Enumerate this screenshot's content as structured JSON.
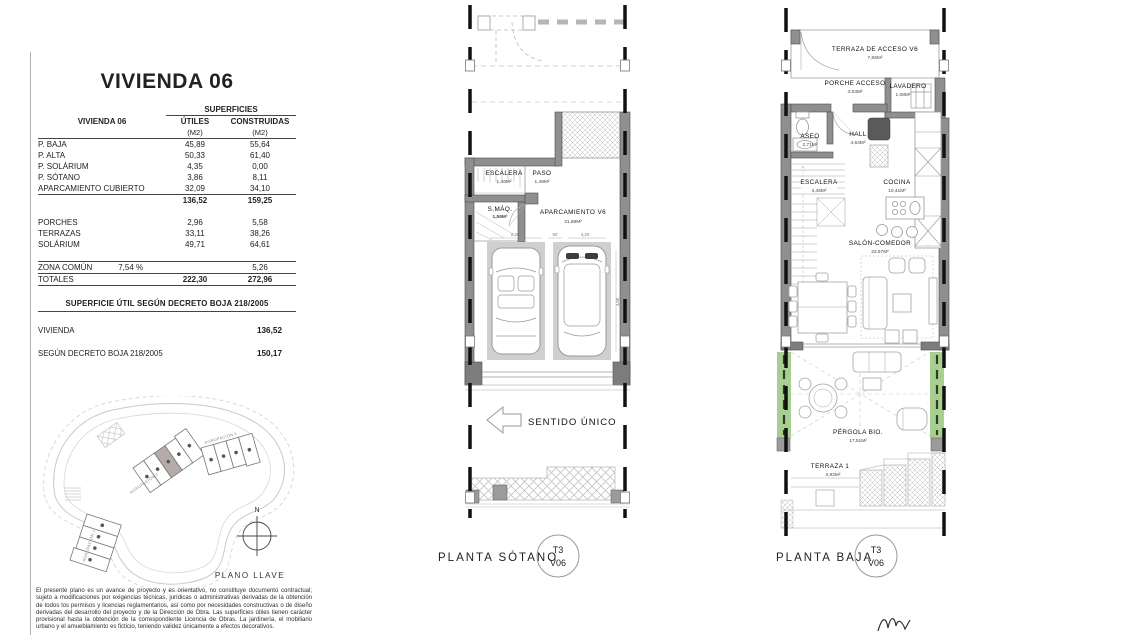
{
  "left_panel": {
    "title": "VIVIENDA 06",
    "areas_table": {
      "corner_label": "VIVIENDA 06",
      "group_header": "SUPERFICIES",
      "col_utiles": "ÚTILES",
      "col_construidas": "CONSTRUIDAS",
      "unit": "(M2)",
      "rows": [
        {
          "label": "P. BAJA",
          "utiles": "45,89",
          "construidas": "55,64"
        },
        {
          "label": "P. ALTA",
          "utiles": "50,33",
          "construidas": "61,40"
        },
        {
          "label": "P. SOLÁRIUM",
          "utiles": "4,35",
          "construidas": "0,00"
        },
        {
          "label": "P. SÓTANO",
          "utiles": "3,86",
          "construidas": "8,11"
        },
        {
          "label": "APARCAMIENTO CUBIERTO",
          "utiles": "32,09",
          "construidas": "34,10"
        }
      ],
      "subtotal": {
        "utiles": "136,52",
        "construidas": "159,25"
      },
      "extra_rows": [
        {
          "label": "PORCHES",
          "utiles": "2,96",
          "construidas": "5,58"
        },
        {
          "label": "TERRAZAS",
          "utiles": "33,11",
          "construidas": "38,26"
        },
        {
          "label": "SOLÁRIUM",
          "utiles": "49,71",
          "construidas": "64,61"
        }
      ],
      "zona_comun": {
        "label": "ZONA COMÚN",
        "pct": "7,54 %",
        "construidas": "5,26"
      },
      "totales": {
        "label": "TOTALES",
        "utiles": "222,30",
        "construidas": "272,96"
      }
    },
    "decreto_table": {
      "header": "SUPERFICIE ÚTIL SEGÚN DECRETO BOJA 218/2005",
      "rows": [
        {
          "label": "VIVIENDA",
          "value": "136,52"
        },
        {
          "label": "SEGÚN DECRETO BOJA 218/2005",
          "value": "150,17"
        }
      ]
    },
    "site_plan": {
      "north": "N",
      "caption": "PLANO LLAVE",
      "agrupacion1": "AGRUPACIÓN 1",
      "agrupacion2": "AGRUPACIÓN 2",
      "agrupacion3": "AGRUPACIÓN 3"
    },
    "disclaimer": "El presente plano es un avance de proyecto y es orientativo, no constituye documento contractual; sujeto a modificaciones por exigencias técnicas, jurídicas o administrativas derivadas de la obtención de todos los permisos y licencias reglamentarios, así como por necesidades constructivas o de diseño derivadas del desarrollo del proyecto y de la Dirección de Obra. Las superficies útiles tienen carácter provisional hasta la obtención de la correspondiente Licencia de Obras. La jardinería, el mobiliario urbano y el amueblamiento es ficticio, teniendo validez únicamente a efectos decorativos."
  },
  "sotano": {
    "caption": "PLANTA SÓTANO",
    "badge": {
      "top": "T3",
      "bottom": "V06"
    },
    "direction": "SENTIDO ÚNICO",
    "rooms": {
      "escalera": {
        "name": "ESCALERA",
        "area": "1,46M²"
      },
      "paso": {
        "name": "PASO",
        "area": "1,49M²"
      },
      "smaq": {
        "name": "S.MÁQ.",
        "area": "1,59M²"
      },
      "aparcamiento": {
        "name": "APARCAMIENTO V6",
        "area": "31,88M²"
      }
    },
    "dims": {
      "left": "2,20",
      "mid": "50",
      "right": "4,20",
      "vert": "4,50"
    }
  },
  "baja": {
    "caption": "PLANTA BAJA",
    "badge": {
      "top": "T3",
      "bottom": "V06"
    },
    "rooms": {
      "terraza_acceso": {
        "name": "TERRAZA DE ACCESO V6",
        "area": "7,66M²"
      },
      "porche": {
        "name": "PORCHE ACCESO",
        "area": "3,53M²"
      },
      "lavadero": {
        "name": "LAVADERO",
        "area": "1,08M²"
      },
      "aseo": {
        "name": "ASEO",
        "area": "2,71M²"
      },
      "hall": {
        "name": "HALL",
        "area": "4,64M²"
      },
      "escalera": {
        "name": "ESCALERA",
        "area": "4,46M²"
      },
      "cocina": {
        "name": "COCINA",
        "area": "10,41M²"
      },
      "salon": {
        "name": "SALÓN-COMEDOR",
        "area": "23,67M²"
      },
      "pergola": {
        "name": "PÉRGOLA BIO.",
        "area": "17,51M²"
      },
      "terraza1": {
        "name": "TERRAZA 1",
        "area": "3,92M²"
      }
    }
  },
  "colors": {
    "wall": "#8f8f8f",
    "wall_edge": "#4d4d4d",
    "stall": "#cfcfcf",
    "green": "#a7cf90",
    "section_line": "#111111",
    "highlight_unit": "#b5aba9"
  }
}
